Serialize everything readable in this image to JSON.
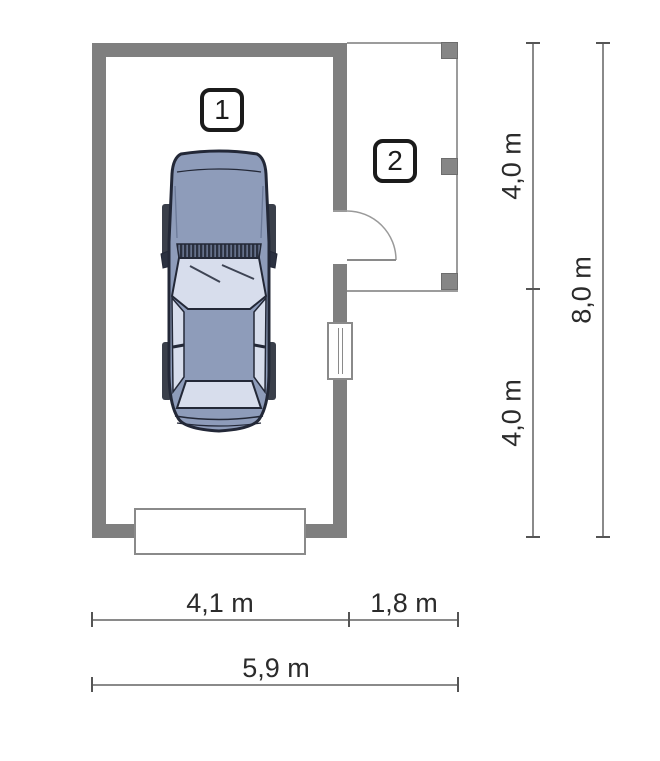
{
  "rooms": [
    {
      "number": "1"
    },
    {
      "number": "2"
    }
  ],
  "dimensions": {
    "bottom": {
      "segments": [
        "4,1 m",
        "1,8 m"
      ],
      "total": "5,9 m"
    },
    "right": {
      "segments": [
        "4,0 m",
        "4,0 m"
      ],
      "total": "8,0 m"
    }
  },
  "colors": {
    "wall": "#7f7f7f",
    "pillar": "#868686",
    "car_body": "#8e9cba",
    "car_window": "#d7ddec",
    "car_outline": "#232837",
    "dim_line": "#8a8a8a",
    "dim_text": "#2b2b2b"
  }
}
